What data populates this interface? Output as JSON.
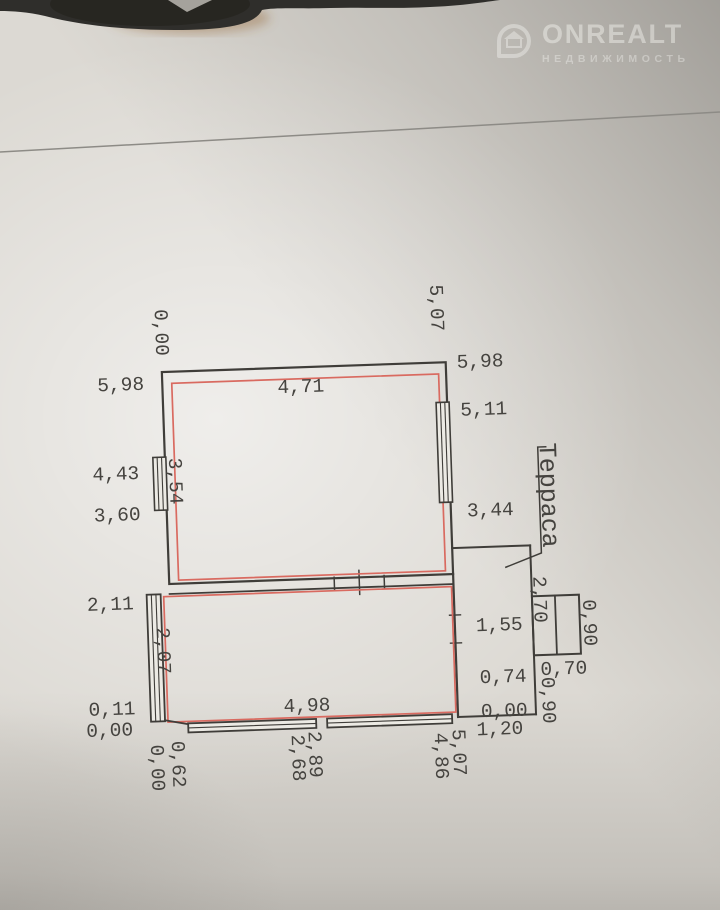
{
  "watermark": {
    "brand": "ONREALT",
    "tagline": "НЕДВИЖИМОСТЬ"
  },
  "plan": {
    "terrace_label": "Терраса",
    "dims": {
      "top_left_elev": "0,00",
      "top_right_elev": "5,07",
      "left_wall_len": "5,98",
      "left_win_top": "4,43",
      "left_win_bottom": "3,60",
      "left_mid_elev": "2,11",
      "bottom_left_step": "0,11",
      "bottom_left_elev": "0,00",
      "upper_room_width": "4,71",
      "upper_room_left_inner": "3,54",
      "lower_room_left_inner": "2,07",
      "lower_room_width": "4,98",
      "right_wall_len": "5,98",
      "right_win_top": "5,11",
      "right_win_bottom": "3,44",
      "terrace_top": "1,55",
      "terrace_mid": "0,74",
      "terrace_elev": "0,00",
      "terrace_bottom_width": "1,20",
      "porch_side": "2,70",
      "porch_right_side": "0,90",
      "porch_width": "0,70",
      "porch_below": "0,90",
      "bottom_left_pair_outer": "0,00",
      "bottom_left_pair_inner": "0,62",
      "bottom_center_pair_left": "2,68",
      "bottom_center_pair_right": "2,89",
      "bottom_right_pair_left": "4,86",
      "bottom_right_pair_right": "5,07"
    }
  },
  "colors": {
    "wall": "#3f3d39",
    "plan_red": "#d96a60",
    "paper": "#dcd9d3"
  }
}
